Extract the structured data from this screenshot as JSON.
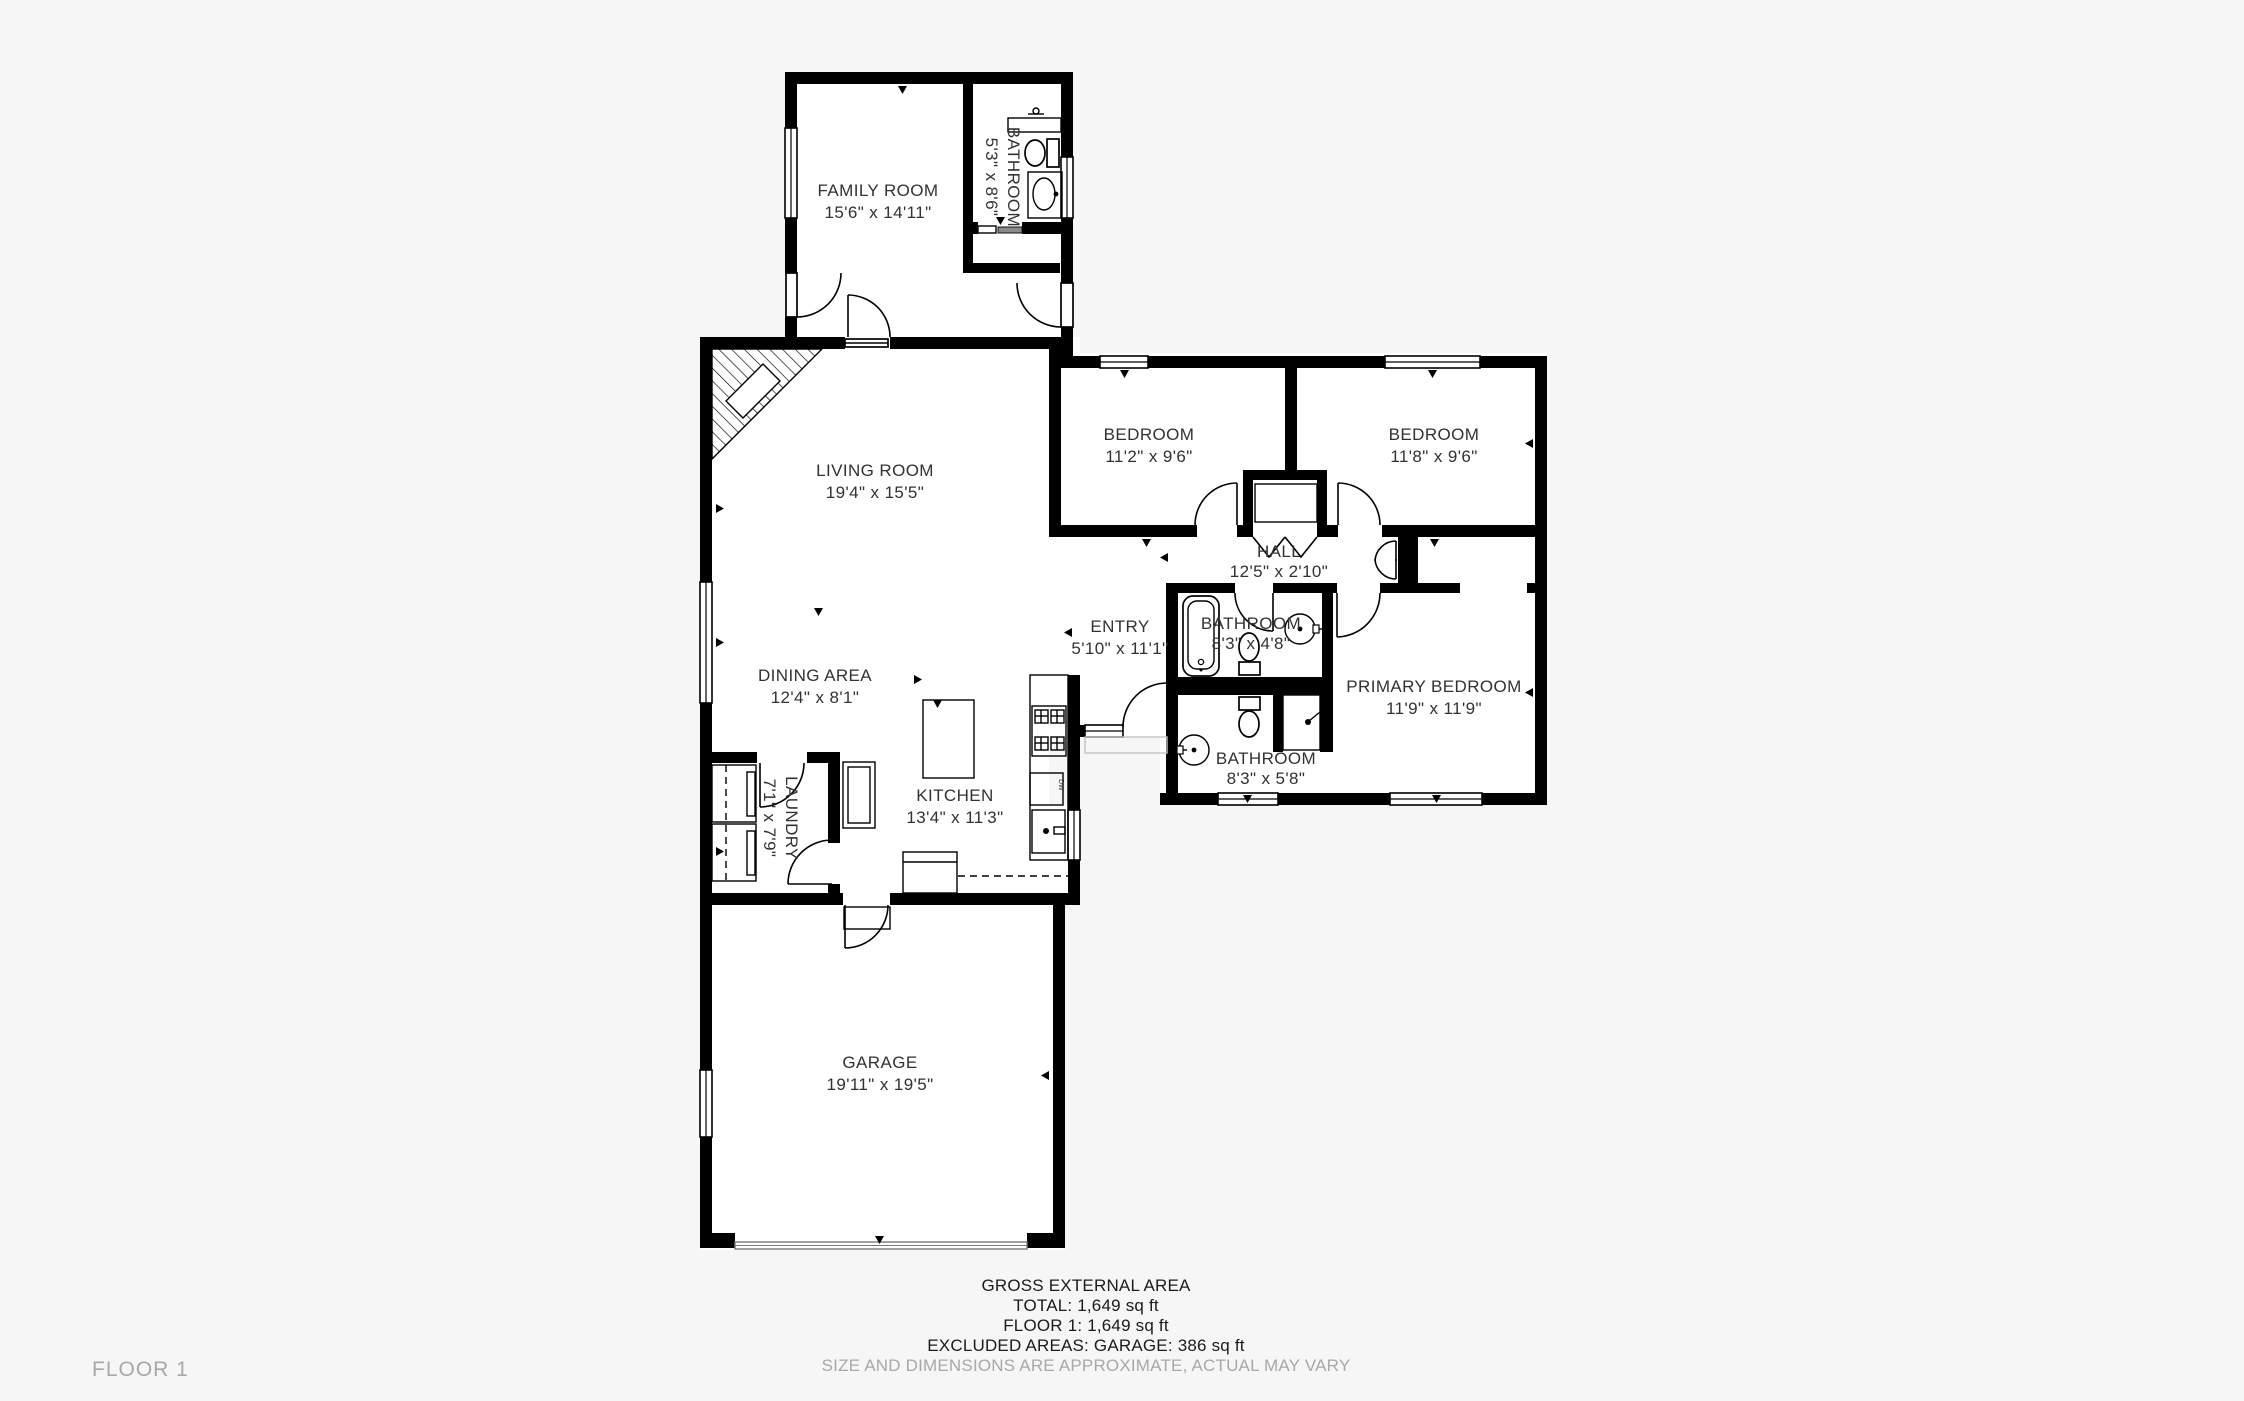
{
  "rooms": {
    "family_room": {
      "name": "FAMILY ROOM",
      "dims": "15'6\" x 14'11\""
    },
    "bathroom_top": {
      "name": "BATHROOM",
      "dims": "5'3\" x 8'6\""
    },
    "living_room": {
      "name": "LIVING ROOM",
      "dims": "19'4\" x 15'5\""
    },
    "bedroom_left": {
      "name": "BEDROOM",
      "dims": "11'2\" x 9'6\""
    },
    "bedroom_right": {
      "name": "BEDROOM",
      "dims": "11'8\" x 9'6\""
    },
    "hall": {
      "name": "HALL",
      "dims": "12'5\" x 2'10\""
    },
    "entry": {
      "name": "ENTRY",
      "dims": "5'10\" x 11'1\""
    },
    "bathroom_hall": {
      "name": "BATHROOM",
      "dims": "8'3\" x 4'8\""
    },
    "primary_bedroom": {
      "name": "PRIMARY BEDROOM",
      "dims": "11'9\" x 11'9\""
    },
    "bathroom_lower": {
      "name": "BATHROOM",
      "dims": "8'3\" x 5'8\""
    },
    "dining_area": {
      "name": "DINING AREA",
      "dims": "12'4\" x 8'1\""
    },
    "kitchen": {
      "name": "KITCHEN",
      "dims": "13'4\" x 11'3\""
    },
    "laundry": {
      "name": "LAUNDRY",
      "dims": "7'1\" x 7'9\""
    },
    "garage": {
      "name": "GARAGE",
      "dims": "19'11\" x 19'5\""
    }
  },
  "fixtures": {
    "dishwasher_label": "DW"
  },
  "summary": {
    "title": "GROSS EXTERNAL AREA",
    "total": "TOTAL: 1,649 sq ft",
    "floor": "FLOOR 1: 1,649 sq ft",
    "excluded": "EXCLUDED AREAS: GARAGE: 386 sq ft",
    "disclaimer": "SIZE AND DIMENSIONS ARE APPROXIMATE, ACTUAL MAY VARY"
  },
  "floor_label": "FLOOR 1",
  "colors": {
    "wall": "#000000",
    "label": "#323232",
    "muted": "#a8a8a8",
    "background": "#f6f6f6",
    "plan_floor": "#ffffff"
  }
}
